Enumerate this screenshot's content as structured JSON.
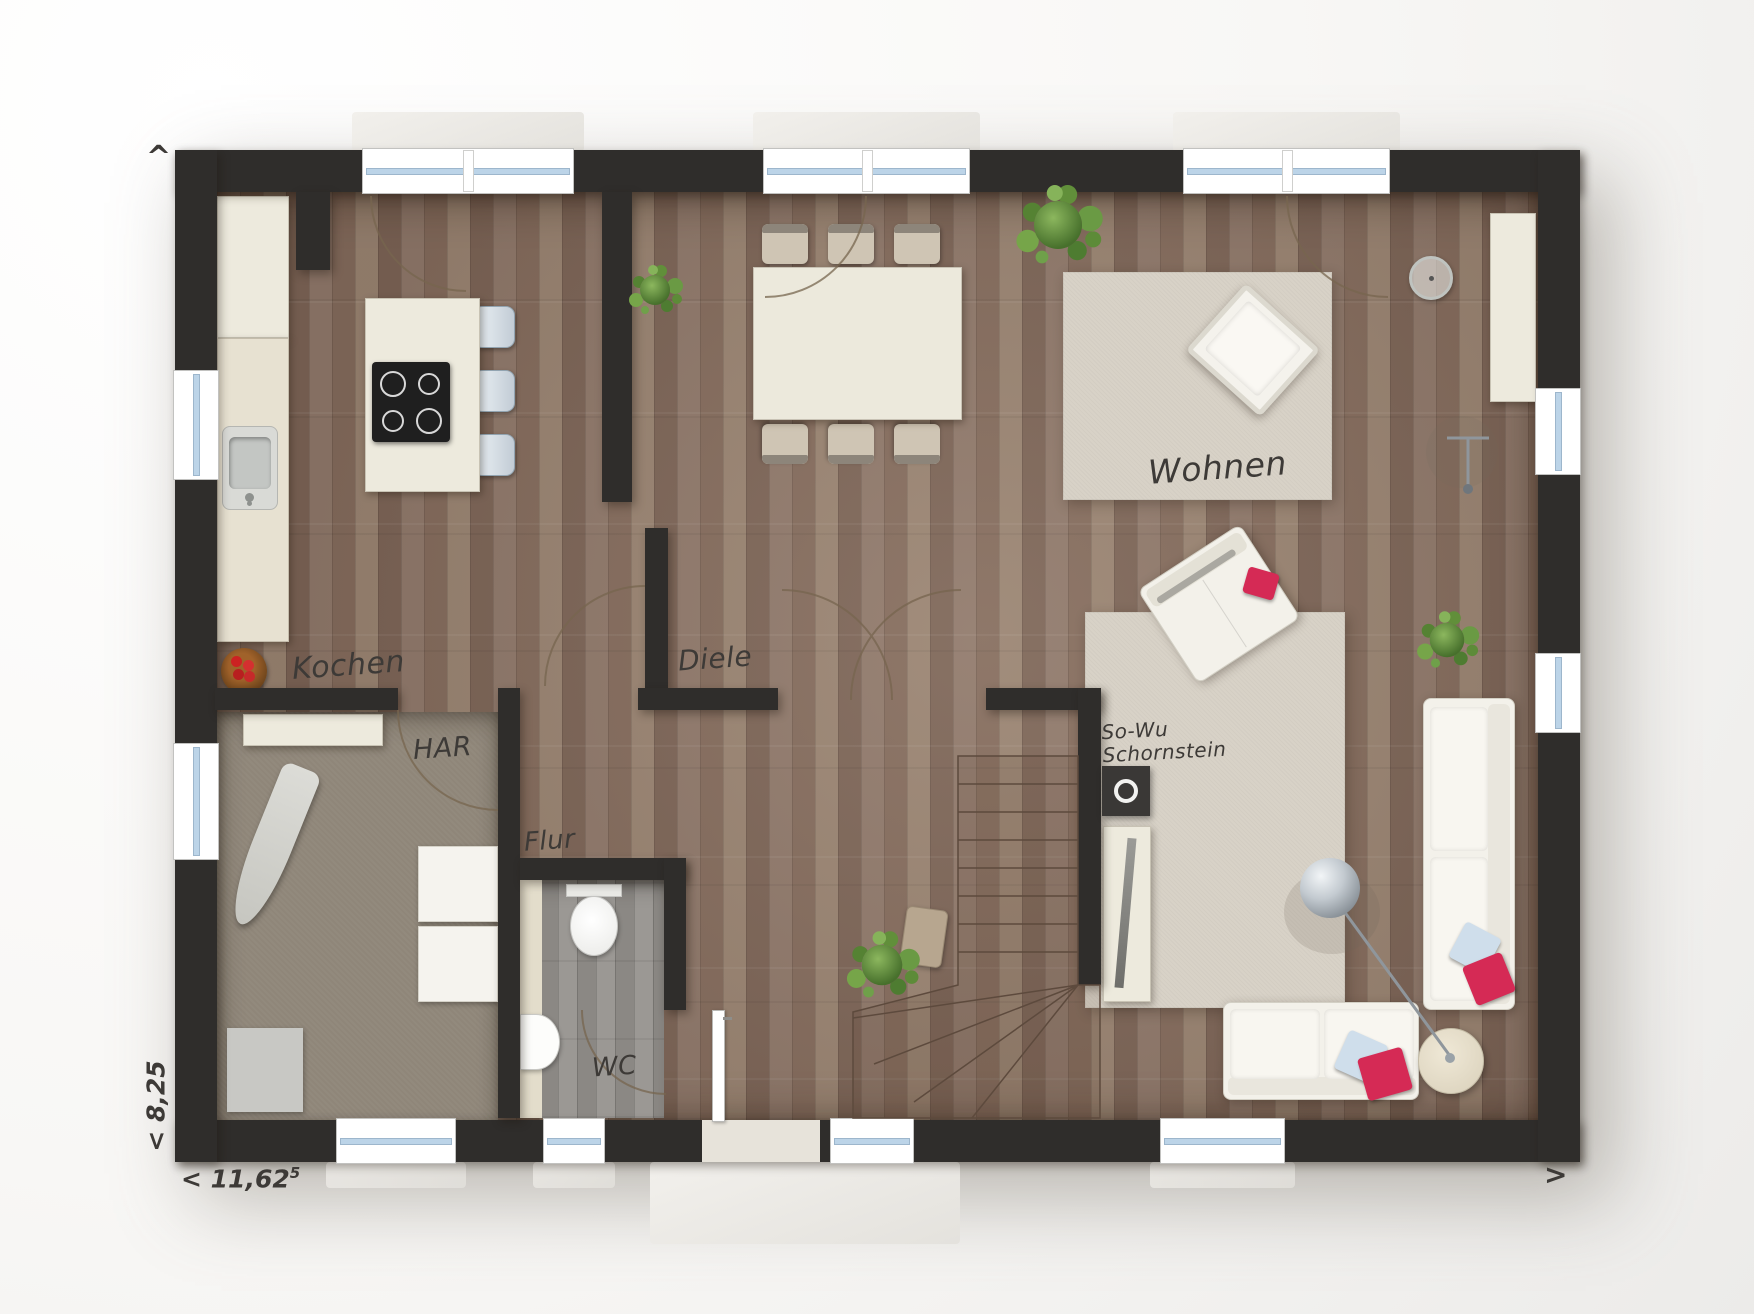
{
  "labels": {
    "kochen": "Kochen",
    "diele": "Diele",
    "flur": "Flur",
    "har": "HAR",
    "wc": "WC",
    "wohnen": "Wohnen",
    "chimney_line1": "So-Wu",
    "chimney_line2": "Schornstein"
  },
  "dimensions": {
    "width_label": "< 11,62",
    "width_sup": "5",
    "depth_label": "< 8,25",
    "arrow_top": "^",
    "arrow_right": ">"
  },
  "colors": {
    "wall": "#2f2d2b",
    "wood_dark": "#82695a",
    "wood_mid": "#8d7668",
    "wood_light": "#97816f",
    "har_floor": "#8f8679",
    "wc_floor_a": "#9b9894",
    "wc_floor_b": "#8b8884",
    "rug": "#d8d2c7",
    "cream": "#edeadd",
    "stool_blue": "#c2ccd5",
    "pillow_red": "#d52a55",
    "pillow_blue": "#cfdeeb",
    "glass_blue": "#bcd4e8",
    "plant_green": "#6a9a44",
    "ink": "#3d3a37"
  }
}
